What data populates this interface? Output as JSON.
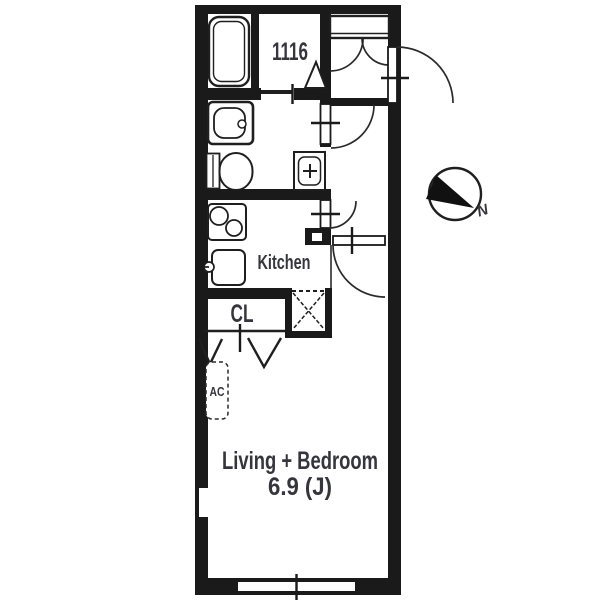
{
  "plan": {
    "type": "apartment-floor-plan",
    "labels": {
      "bath_size": "1116",
      "kitchen": "Kitchen",
      "closet": "CL",
      "air_conditioner": "AC",
      "living": "Living + Bedroom",
      "living_area": "6.9 (J)",
      "compass_north": "N"
    },
    "rooms": [
      {
        "name": "Bath",
        "label": "1116",
        "fixtures": [
          "bathtub",
          "folding-door"
        ]
      },
      {
        "name": "Washroom-Toilet",
        "fixtures": [
          "washing-machine-pan",
          "toilet",
          "washbasin"
        ]
      },
      {
        "name": "Kitchen",
        "label": "Kitchen",
        "fixtures": [
          "two-burner-stove",
          "sink"
        ]
      },
      {
        "name": "Closet",
        "label": "CL",
        "fixtures": [
          "bi-fold-doors"
        ]
      },
      {
        "name": "Living + Bedroom",
        "label": "Living + Bedroom",
        "size": "6.9 (J)",
        "fixtures": [
          "air-conditioner",
          "window"
        ]
      },
      {
        "name": "Entrance-Corridor",
        "fixtures": [
          "shoe-storage",
          "front-door",
          "pipe-space"
        ]
      }
    ],
    "colors": {
      "wall": "#1a1a1a",
      "text": "#35353c",
      "background": "#ffffff"
    }
  }
}
